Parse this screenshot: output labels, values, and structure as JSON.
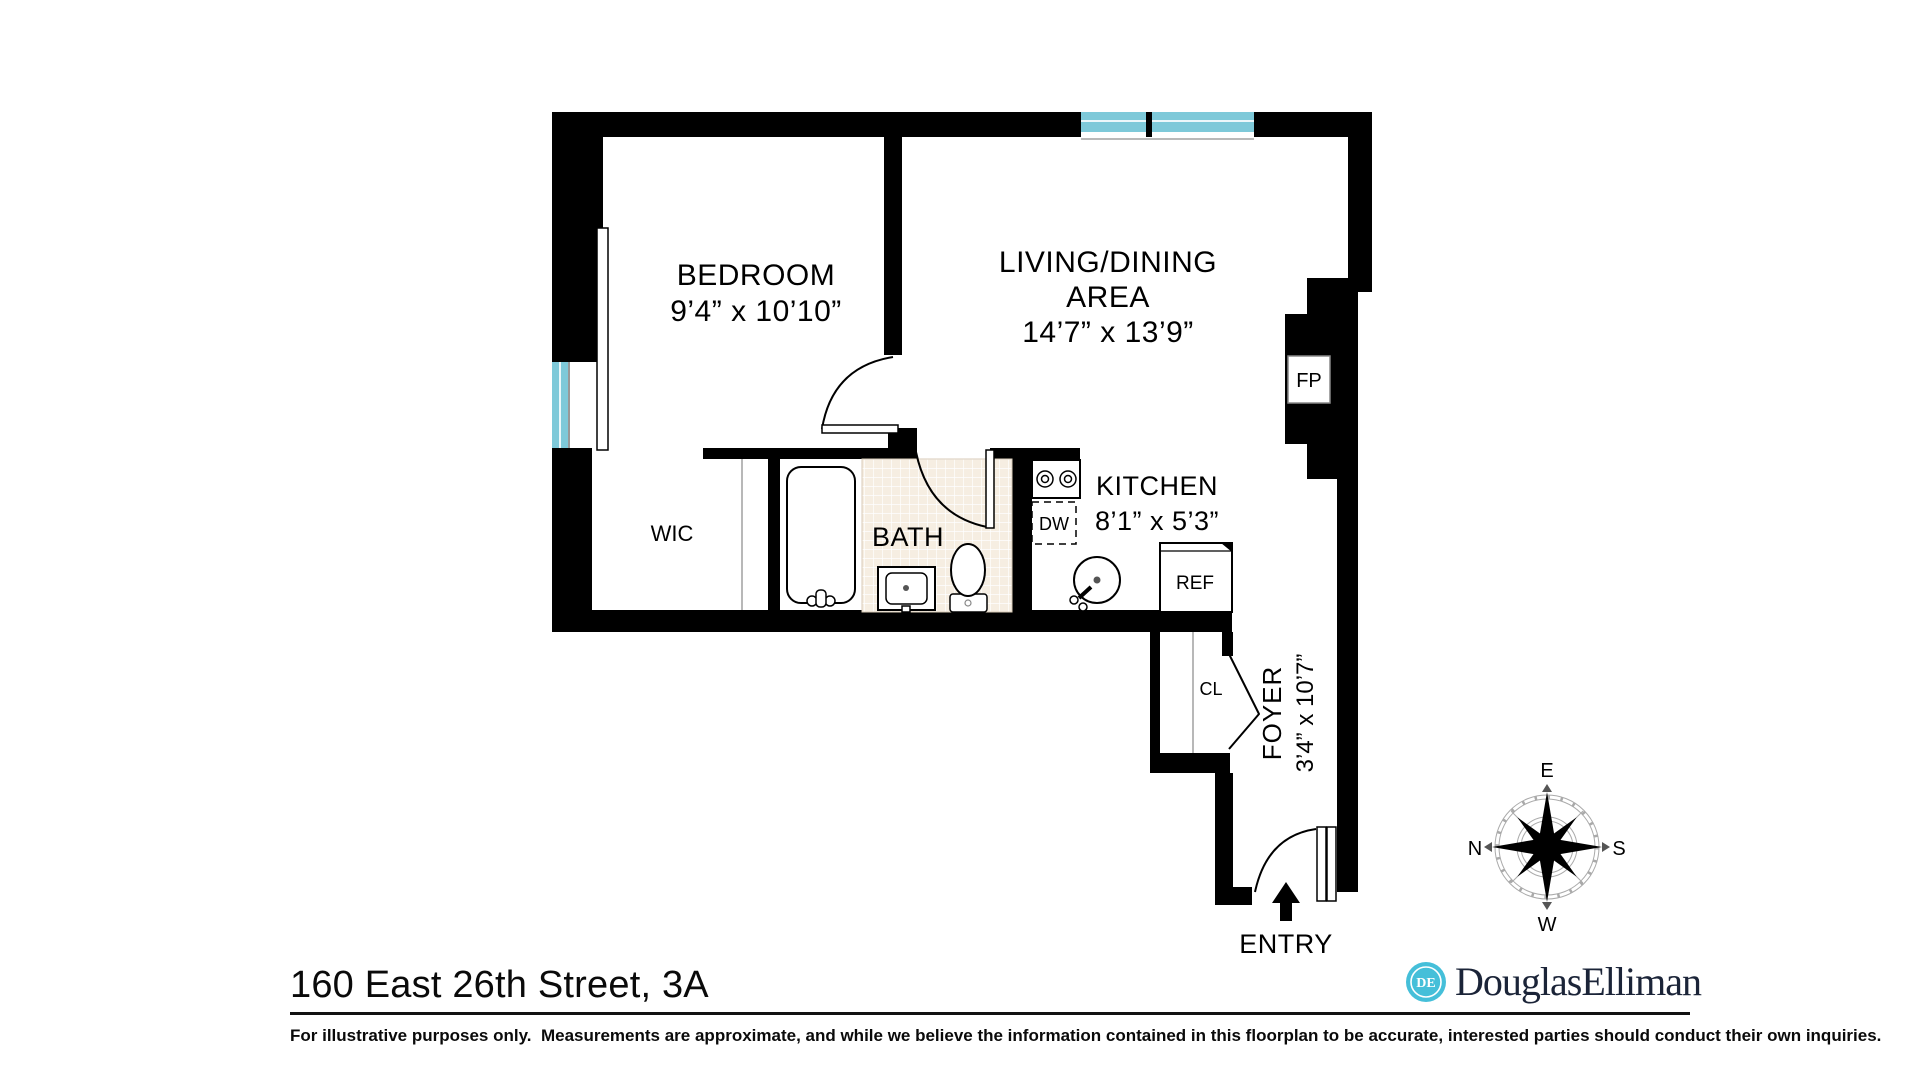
{
  "plan": {
    "bedroom": {
      "label": "BEDROOM",
      "dims": "9’4” x 10’10”"
    },
    "living_dining": {
      "label_line1": "LIVING/DINING",
      "label_line2": "AREA",
      "dims": "14’7” x 13’9”"
    },
    "kitchen": {
      "label": "KITCHEN",
      "dims": "8’1” x 5’3”"
    },
    "bath": {
      "label": "BATH"
    },
    "wic": {
      "label": "WIC"
    },
    "foyer": {
      "label": "FOYER",
      "dims": "3’4” x 10’7”"
    },
    "closet_label": "CL",
    "fireplace_label": "FP",
    "dishwasher_label": "DW",
    "refrigerator_label": "REF",
    "entry_label": "ENTRY",
    "compass": {
      "top": "E",
      "right": "S",
      "bottom": "W",
      "left": "N"
    }
  },
  "footer": {
    "address": "160 East 26th Street, 3A",
    "disclaimer": "For illustrative purposes only.  Measurements are approximate, and while we believe the information contained in this floorplan to be accurate, interested parties should conduct their own inquiries.",
    "brand_monogram": "DE",
    "brand_name": "DouglasElliman"
  },
  "colors": {
    "wall": "#000000",
    "window_glass": "#7ec9d9",
    "bath_tile": "#f6eee2",
    "brand_teal": "#45bfd9",
    "brand_navy": "#1b2438"
  }
}
